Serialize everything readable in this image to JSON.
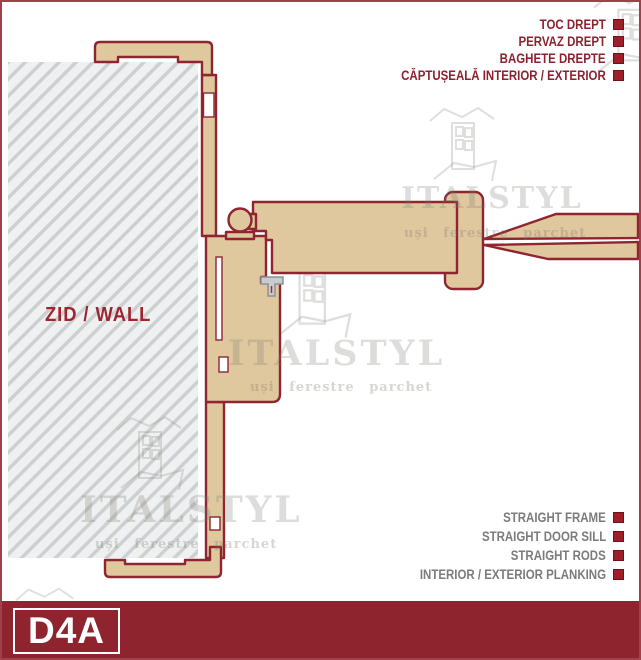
{
  "diagram": {
    "code": "D4A",
    "wall_label": "ZID / WALL"
  },
  "legend_top": {
    "items": [
      "TOC DREPT",
      "PERVAZ DREPT",
      "BAGHETE DREPTE",
      "CĂPTUȘEALĂ INTERIOR / EXTERIOR"
    ]
  },
  "legend_bottom": {
    "items": [
      "STRAIGHT FRAME",
      "STRAIGHT DOOR SILL",
      "STRAIGHT RODS",
      "INTERIOR / EXTERIOR PLANKING"
    ]
  },
  "watermark": {
    "brand": "ITALSTYL",
    "tagline": "uși ferestre parchet"
  },
  "colors": {
    "banner_red": "#8e242e",
    "border_red": "#a04048",
    "legend_red": "#8c2130",
    "legend_gray": "#7b7b7b",
    "square_red": "#9e1f29",
    "profile_fill": "#dfc79e",
    "profile_stroke": "#8e2531",
    "hatch_bg": "#eff1f1",
    "hatch_line": "#ccd0d2",
    "seal_gray": "#c9ccce"
  }
}
